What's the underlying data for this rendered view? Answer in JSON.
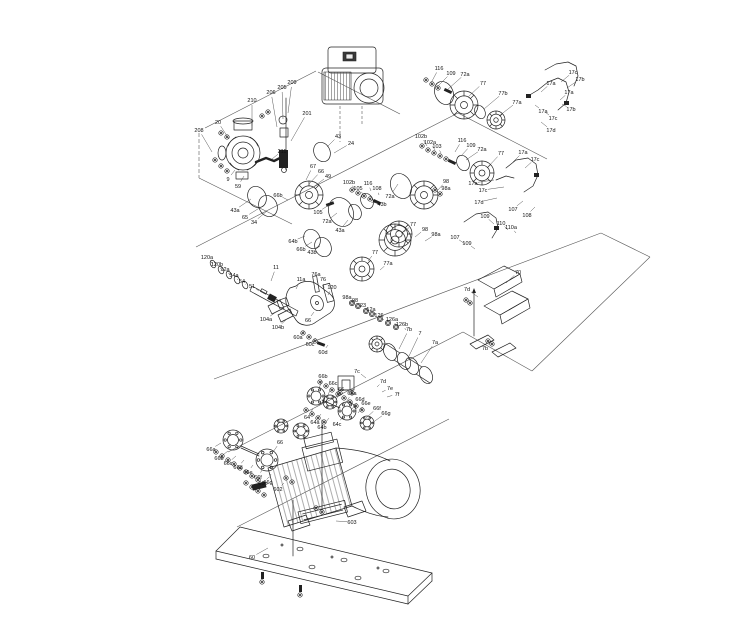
{
  "diagram": {
    "type": "exploded-parts-diagram",
    "subject": "inline centrifugal pump with electronic motor - exploded service parts view",
    "background": "#ffffff",
    "line_color": "#222222",
    "label_color": "#111111",
    "callouts": [
      {
        "t": "208",
        "x": 199,
        "y": 130,
        "tx": 212,
        "ty": 152
      },
      {
        "t": "20",
        "x": 218,
        "y": 122,
        "tx": 229,
        "ty": 139
      },
      {
        "t": "210",
        "x": 252,
        "y": 100,
        "tx": 252,
        "ty": 126
      },
      {
        "t": "206",
        "x": 271,
        "y": 92,
        "tx": 277,
        "ty": 127
      },
      {
        "t": "205",
        "x": 282,
        "y": 87,
        "tx": 283,
        "ty": 119
      },
      {
        "t": "209",
        "x": 292,
        "y": 82,
        "tx": 288,
        "ty": 113
      },
      {
        "t": "201",
        "x": 307,
        "y": 113,
        "tx": 291,
        "ty": 141
      },
      {
        "t": "211",
        "x": 282,
        "y": 151,
        "tx": 272,
        "ty": 159
      },
      {
        "t": "9",
        "x": 228,
        "y": 179,
        "tx": 235,
        "ty": 170
      },
      {
        "t": "59",
        "x": 238,
        "y": 186,
        "tx": 244,
        "ty": 176
      },
      {
        "t": "43a",
        "x": 235,
        "y": 210,
        "tx": 251,
        "ty": 199
      },
      {
        "t": "65",
        "x": 245,
        "y": 217,
        "tx": 261,
        "ty": 207
      },
      {
        "t": "34",
        "x": 254,
        "y": 222,
        "tx": 267,
        "ty": 211
      },
      {
        "t": "66b",
        "x": 278,
        "y": 195,
        "tx": 288,
        "ty": 200
      },
      {
        "t": "43",
        "x": 338,
        "y": 136,
        "tx": 327,
        "ty": 147
      },
      {
        "t": "24",
        "x": 351,
        "y": 143,
        "tx": 334,
        "ty": 153
      },
      {
        "t": "67",
        "x": 313,
        "y": 166,
        "tx": 306,
        "ty": 180
      },
      {
        "t": "66",
        "x": 321,
        "y": 171,
        "tx": 309,
        "ty": 184
      },
      {
        "t": "49",
        "x": 328,
        "y": 176,
        "tx": 312,
        "ty": 188
      },
      {
        "t": "105",
        "x": 318,
        "y": 212,
        "tx": 329,
        "ty": 205
      },
      {
        "t": "72a",
        "x": 327,
        "y": 221,
        "tx": 337,
        "ty": 213
      },
      {
        "t": "43a",
        "x": 340,
        "y": 230,
        "tx": 348,
        "ty": 220
      },
      {
        "t": "64b",
        "x": 293,
        "y": 241,
        "tx": 305,
        "ty": 236
      },
      {
        "t": "66b",
        "x": 301,
        "y": 249,
        "tx": 312,
        "ty": 242
      },
      {
        "t": "43b",
        "x": 312,
        "y": 252,
        "tx": 320,
        "ty": 246
      },
      {
        "t": "116",
        "x": 439,
        "y": 68,
        "tx": 431,
        "ty": 83
      },
      {
        "t": "109",
        "x": 451,
        "y": 73,
        "tx": 437,
        "ty": 87
      },
      {
        "t": "72a",
        "x": 465,
        "y": 74,
        "tx": 447,
        "ty": 90
      },
      {
        "t": "77",
        "x": 483,
        "y": 83,
        "tx": 468,
        "ty": 97
      },
      {
        "t": "77b",
        "x": 503,
        "y": 93,
        "tx": 484,
        "ty": 109
      },
      {
        "t": "77a",
        "x": 517,
        "y": 102,
        "tx": 499,
        "ty": 116
      },
      {
        "t": "17c",
        "x": 573,
        "y": 72,
        "tx": 561,
        "ty": 82
      },
      {
        "t": "17b",
        "x": 580,
        "y": 79,
        "tx": 567,
        "ty": 88
      },
      {
        "t": "17a",
        "x": 551,
        "y": 83,
        "tx": 541,
        "ty": 92
      },
      {
        "t": "17a",
        "x": 569,
        "y": 92,
        "tx": 560,
        "ty": 100
      },
      {
        "t": "17b",
        "x": 571,
        "y": 109,
        "tx": 562,
        "ty": 104
      },
      {
        "t": "17a",
        "x": 543,
        "y": 111,
        "tx": 535,
        "ty": 105
      },
      {
        "t": "17c",
        "x": 553,
        "y": 118,
        "tx": 545,
        "ty": 112
      },
      {
        "t": "17d",
        "x": 551,
        "y": 130,
        "tx": 541,
        "ty": 122
      },
      {
        "t": "102b",
        "x": 421,
        "y": 136,
        "tx": 427,
        "ty": 146
      },
      {
        "t": "102a",
        "x": 430,
        "y": 142,
        "tx": 435,
        "ty": 150
      },
      {
        "t": "103",
        "x": 437,
        "y": 146,
        "tx": 441,
        "ty": 153
      },
      {
        "t": "116",
        "x": 462,
        "y": 140,
        "tx": 455,
        "ty": 152
      },
      {
        "t": "109",
        "x": 471,
        "y": 145,
        "tx": 461,
        "ty": 156
      },
      {
        "t": "72a",
        "x": 482,
        "y": 149,
        "tx": 466,
        "ty": 160
      },
      {
        "t": "77",
        "x": 501,
        "y": 153,
        "tx": 488,
        "ty": 167
      },
      {
        "t": "17a",
        "x": 523,
        "y": 152,
        "tx": 513,
        "ty": 162
      },
      {
        "t": "17c",
        "x": 535,
        "y": 159,
        "tx": 525,
        "ty": 168
      },
      {
        "t": "102b",
        "x": 349,
        "y": 182,
        "tx": 356,
        "ty": 190
      },
      {
        "t": "105",
        "x": 358,
        "y": 188,
        "tx": 363,
        "ty": 194
      },
      {
        "t": "116",
        "x": 368,
        "y": 183,
        "tx": 371,
        "ty": 191
      },
      {
        "t": "108",
        "x": 377,
        "y": 188,
        "tx": 379,
        "ty": 195
      },
      {
        "t": "72a",
        "x": 390,
        "y": 196,
        "tx": 398,
        "ty": 184
      },
      {
        "t": "98",
        "x": 446,
        "y": 181,
        "tx": 438,
        "ty": 190
      },
      {
        "t": "98a",
        "x": 446,
        "y": 188,
        "tx": 439,
        "ty": 195
      },
      {
        "t": "43b",
        "x": 382,
        "y": 204,
        "tx": 371,
        "ty": 202
      },
      {
        "t": "17a",
        "x": 473,
        "y": 183,
        "tx": 494,
        "ty": 180
      },
      {
        "t": "17c",
        "x": 483,
        "y": 190,
        "tx": 504,
        "ty": 187
      },
      {
        "t": "17d",
        "x": 479,
        "y": 202,
        "tx": 497,
        "ty": 198
      },
      {
        "t": "107",
        "x": 513,
        "y": 209,
        "tx": 523,
        "ty": 201
      },
      {
        "t": "108",
        "x": 527,
        "y": 215,
        "tx": 535,
        "ty": 207
      },
      {
        "t": "109",
        "x": 485,
        "y": 216,
        "tx": 494,
        "ty": 224
      },
      {
        "t": "110",
        "x": 501,
        "y": 223,
        "tx": 508,
        "ty": 230
      },
      {
        "t": "110a",
        "x": 511,
        "y": 227,
        "tx": 516,
        "ty": 233
      },
      {
        "t": "107",
        "x": 455,
        "y": 237,
        "tx": 465,
        "ty": 244
      },
      {
        "t": "109",
        "x": 467,
        "y": 243,
        "tx": 475,
        "ty": 249
      },
      {
        "t": "77",
        "x": 413,
        "y": 224,
        "tx": 404,
        "ty": 232
      },
      {
        "t": "98",
        "x": 425,
        "y": 229,
        "tx": 415,
        "ty": 237
      },
      {
        "t": "98a",
        "x": 436,
        "y": 234,
        "tx": 425,
        "ty": 241
      },
      {
        "t": "77",
        "x": 375,
        "y": 252,
        "tx": 368,
        "ty": 261
      },
      {
        "t": "77a",
        "x": 388,
        "y": 263,
        "tx": 380,
        "ty": 270
      },
      {
        "t": "120a",
        "x": 207,
        "y": 257,
        "tx": 213,
        "ty": 264
      },
      {
        "t": "120b",
        "x": 217,
        "y": 264,
        "tx": 222,
        "ty": 270
      },
      {
        "t": "12a",
        "x": 225,
        "y": 269,
        "tx": 230,
        "ty": 275
      },
      {
        "t": "54a",
        "x": 234,
        "y": 275,
        "tx": 238,
        "ty": 280
      },
      {
        "t": "54",
        "x": 242,
        "y": 281,
        "tx": 246,
        "ty": 285
      },
      {
        "t": "51",
        "x": 252,
        "y": 286,
        "tx": 259,
        "ty": 291
      },
      {
        "t": "11",
        "x": 276,
        "y": 267,
        "tx": 271,
        "ty": 281
      },
      {
        "t": "11a",
        "x": 301,
        "y": 279,
        "tx": 296,
        "ty": 289
      },
      {
        "t": "76a",
        "x": 316,
        "y": 274,
        "tx": 318,
        "ty": 285
      },
      {
        "t": "76",
        "x": 323,
        "y": 279,
        "tx": 324,
        "ty": 288
      },
      {
        "t": "120",
        "x": 332,
        "y": 287,
        "tx": 328,
        "ty": 295
      },
      {
        "t": "104a",
        "x": 266,
        "y": 319,
        "tx": 276,
        "ty": 312
      },
      {
        "t": "104b",
        "x": 278,
        "y": 327,
        "tx": 287,
        "ty": 319
      },
      {
        "t": "66",
        "x": 308,
        "y": 320,
        "tx": 314,
        "ty": 312
      },
      {
        "t": "60a",
        "x": 298,
        "y": 337,
        "tx": 304,
        "ty": 331
      },
      {
        "t": "60c",
        "x": 310,
        "y": 344,
        "tx": 316,
        "ty": 338
      },
      {
        "t": "60d",
        "x": 323,
        "y": 352,
        "tx": 328,
        "ty": 345
      },
      {
        "t": "98a",
        "x": 347,
        "y": 297,
        "tx": 353,
        "ty": 303
      },
      {
        "t": "98",
        "x": 355,
        "y": 300,
        "tx": 360,
        "ty": 306
      },
      {
        "t": "23",
        "x": 363,
        "y": 305,
        "tx": 368,
        "ty": 311
      },
      {
        "t": "12a",
        "x": 371,
        "y": 309,
        "tx": 376,
        "ty": 315
      },
      {
        "t": "126",
        "x": 379,
        "y": 315,
        "tx": 384,
        "ty": 320
      },
      {
        "t": "126a",
        "x": 392,
        "y": 319,
        "tx": 396,
        "ty": 325
      },
      {
        "t": "126b",
        "x": 402,
        "y": 324,
        "tx": 406,
        "ty": 330
      },
      {
        "t": "7b",
        "x": 409,
        "y": 329,
        "tx": 399,
        "ty": 349
      },
      {
        "t": "7",
        "x": 420,
        "y": 333,
        "tx": 409,
        "ty": 356
      },
      {
        "t": "7a",
        "x": 435,
        "y": 342,
        "tx": 421,
        "ty": 363
      },
      {
        "t": "70",
        "x": 518,
        "y": 272,
        "tx": 506,
        "ty": 283
      },
      {
        "t": "7d",
        "x": 467,
        "y": 289,
        "tx": 478,
        "ty": 297
      },
      {
        "t": "7c",
        "x": 357,
        "y": 371,
        "tx": 366,
        "ty": 378
      },
      {
        "t": "7d",
        "x": 383,
        "y": 381,
        "tx": 377,
        "ty": 387
      },
      {
        "t": "7e",
        "x": 390,
        "y": 388,
        "tx": 382,
        "ty": 392
      },
      {
        "t": "7f",
        "x": 397,
        "y": 394,
        "tx": 387,
        "ty": 397
      },
      {
        "t": "7b",
        "x": 485,
        "y": 348,
        "tx": 492,
        "ty": 341
      },
      {
        "t": "66b",
        "x": 323,
        "y": 376,
        "tx": 319,
        "ty": 389
      },
      {
        "t": "66c",
        "x": 333,
        "y": 383,
        "tx": 328,
        "ty": 395
      },
      {
        "t": "66",
        "x": 341,
        "y": 389,
        "tx": 336,
        "ty": 400
      },
      {
        "t": "66a",
        "x": 352,
        "y": 393,
        "tx": 345,
        "ty": 404
      },
      {
        "t": "66d",
        "x": 360,
        "y": 399,
        "tx": 352,
        "ty": 409
      },
      {
        "t": "66e",
        "x": 366,
        "y": 403,
        "tx": 358,
        "ty": 413
      },
      {
        "t": "66f",
        "x": 377,
        "y": 408,
        "tx": 366,
        "ty": 418
      },
      {
        "t": "66g",
        "x": 386,
        "y": 413,
        "tx": 372,
        "ty": 423
      },
      {
        "t": "64",
        "x": 307,
        "y": 417,
        "tx": 313,
        "ty": 409
      },
      {
        "t": "64a",
        "x": 315,
        "y": 422,
        "tx": 321,
        "ty": 414
      },
      {
        "t": "64b",
        "x": 322,
        "y": 427,
        "tx": 329,
        "ty": 418
      },
      {
        "t": "64c",
        "x": 337,
        "y": 424,
        "tx": 343,
        "ty": 417
      },
      {
        "t": "66a",
        "x": 211,
        "y": 449,
        "tx": 221,
        "ty": 443
      },
      {
        "t": "66b",
        "x": 219,
        "y": 458,
        "tx": 228,
        "ty": 451
      },
      {
        "t": "66c",
        "x": 228,
        "y": 463,
        "tx": 236,
        "ty": 456
      },
      {
        "t": "66d",
        "x": 238,
        "y": 467,
        "tx": 244,
        "ty": 460
      },
      {
        "t": "66e",
        "x": 248,
        "y": 472,
        "tx": 253,
        "ty": 465
      },
      {
        "t": "66f",
        "x": 258,
        "y": 477,
        "tx": 262,
        "ty": 470
      },
      {
        "t": "66g",
        "x": 268,
        "y": 482,
        "tx": 271,
        "ty": 474
      },
      {
        "t": "66",
        "x": 280,
        "y": 442,
        "tx": 273,
        "ty": 452
      },
      {
        "t": "60b",
        "x": 263,
        "y": 483,
        "tx": 269,
        "ty": 477
      },
      {
        "t": "602",
        "x": 278,
        "y": 489,
        "tx": 284,
        "ty": 483
      },
      {
        "t": "603",
        "x": 352,
        "y": 522,
        "tx": 336,
        "ty": 521
      },
      {
        "t": "60",
        "x": 252,
        "y": 557,
        "tx": 268,
        "ty": 548
      }
    ]
  }
}
